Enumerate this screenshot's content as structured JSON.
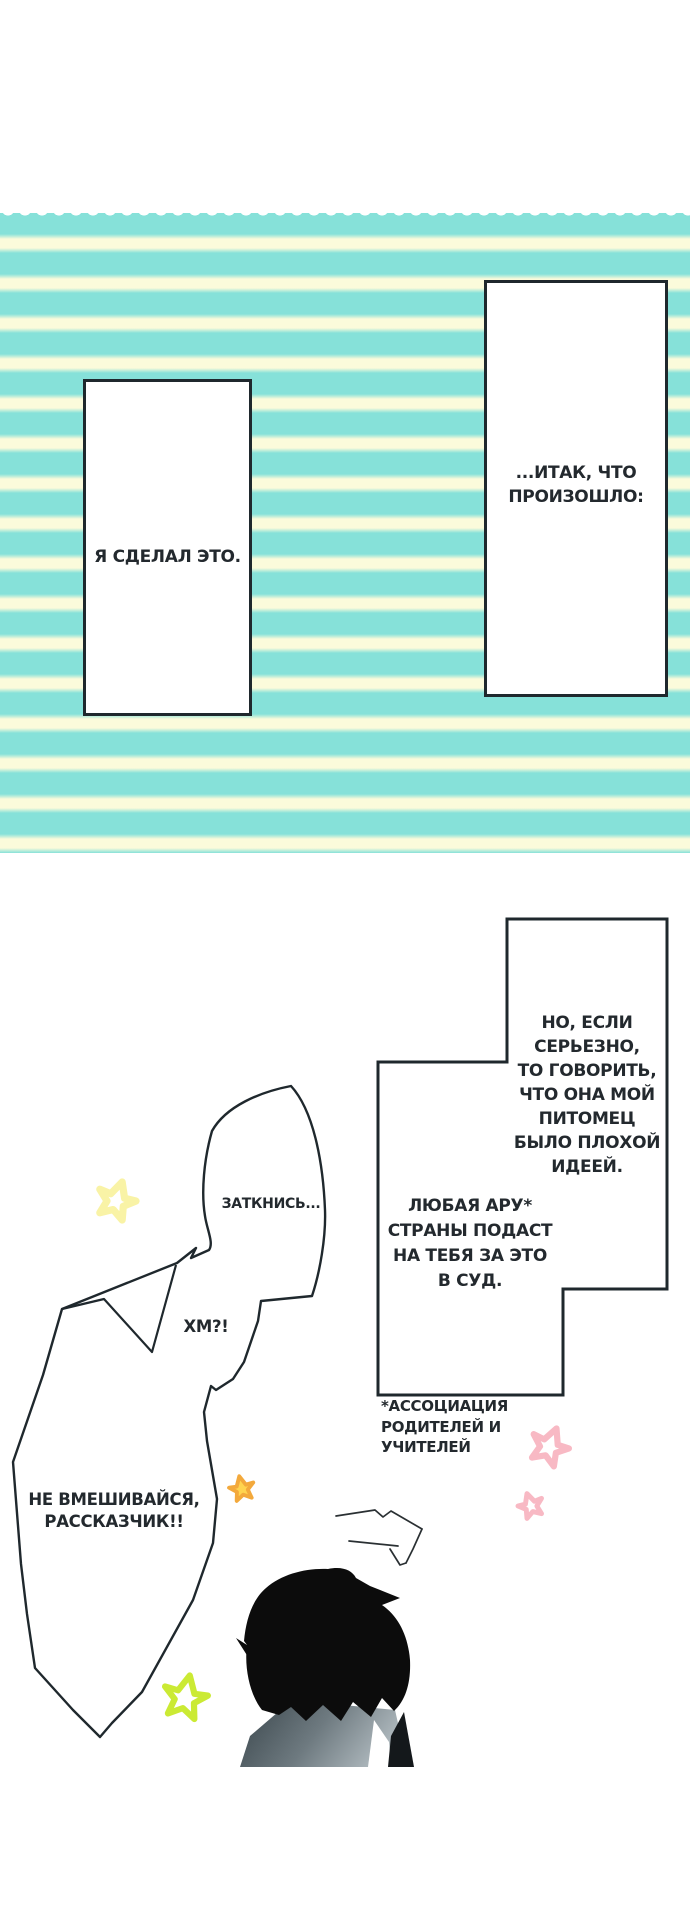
{
  "canvas": {
    "width": 690,
    "height": 1922
  },
  "colors": {
    "background": "#FFFFFF",
    "stripe_teal": "#86E1D9",
    "stripe_cream": "#FBFBDB",
    "outline": "#1F282D",
    "text": "#23292E",
    "hair": "#0C0C0C",
    "shoulder_dark": "#39454B",
    "shoulder_light": "#AEB8BD",
    "star_pale_yellow": "#F9F3A6",
    "star_gold_fill": "#FFD44F",
    "star_gold_stroke": "#F3A93C",
    "star_green": "#CBEA34",
    "star_pink": "#F8B9C4"
  },
  "narration": {
    "panel_left": {
      "text": "Я СДЕЛАЛ ЭТО."
    },
    "panel_right": {
      "lines": [
        "...ИТАК, ЧТО",
        "ПРОИЗОШЛО:"
      ]
    }
  },
  "bubbles": {
    "serious": {
      "lines": [
        "НО, ЕСЛИ",
        "СЕРЬЕЗНО,",
        "ТО ГОВОРИТЬ,",
        "ЧТО ОНА МОЙ",
        "ПИТОМЕЦ",
        "БЫЛО ПЛОХОЙ",
        "ИДЕЕЙ."
      ]
    },
    "pta": {
      "lines": [
        "ЛЮБАЯ АРУ*",
        "СТРАНЫ ПОДАСТ",
        "НА ТЕБЯ ЗА ЭТО",
        "В СУД."
      ]
    },
    "shut_up": {
      "text": "ЗАТКНИСЬ..."
    },
    "hm": {
      "text": "ХМ?!"
    },
    "protest": {
      "lines": [
        "НЕ ВМЕШИВАЙСЯ,",
        "РАССКАЗЧИК!!"
      ]
    }
  },
  "footnote": {
    "lines": [
      "*АССОЦИАЦИЯ",
      "РОДИТЕЛЕЙ И",
      "УЧИТЕЛЕЙ"
    ]
  }
}
